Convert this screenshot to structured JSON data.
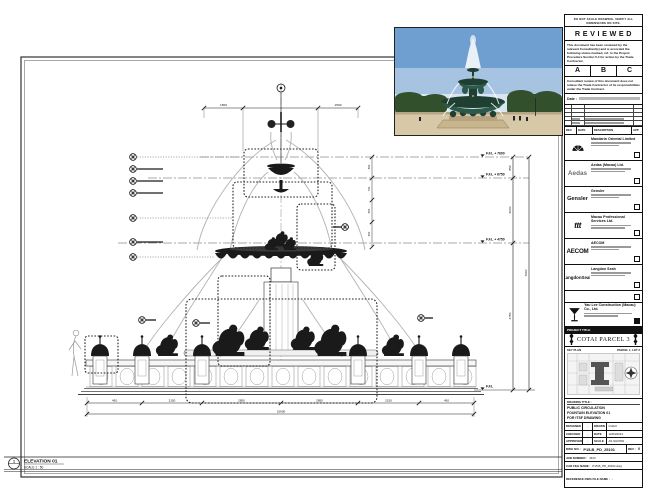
{
  "colors": {
    "ink": "#1a1a1a",
    "sky_top": "#6f9fd0",
    "sky_mid": "#a6c4e2",
    "sky_low": "#d9e6f2",
    "bronze": "#2d5948",
    "bronze_dark": "#1f3f33",
    "stone": "#c8b58e",
    "plaza": "#d7c8a8",
    "tree": "#33502c",
    "spray": "#ffffff"
  },
  "drawing": {
    "view_number": "1",
    "view_title": "ELEVATION 01",
    "view_scale": "SCALE 1 : 50",
    "levels": [
      "F.F.L + 7600",
      "F.F.L + 6750",
      "F.F.L + 4750",
      "F.F.L"
    ],
    "vdims": [
      "850",
      "2000",
      "4750",
      "7600"
    ],
    "top_dims": [
      "1500",
      "1500"
    ],
    "side_dims": [
      "850",
      "700",
      "650",
      "650"
    ],
    "bottom_dims": [
      "450",
      "2150",
      "2850",
      "2850",
      "2150",
      "450"
    ],
    "bottom_overall": "10900"
  },
  "title_block": {
    "disclaimer": "DO NOT SCALE DRAWING. VERIFY ALL DIMENSIONS ON SITE.",
    "stamp": {
      "title": "REVIEWED",
      "para1": "This document has been reviewed by the relevant Consultant(s) and is accorded the following status marked, ref. to the Project Procedure Section 5.4 for action by the Trade Contractor.",
      "statuses": [
        "A",
        "B",
        "C"
      ],
      "para2": "Consultant review of this document does not relieve the Trade Contractor of its responsibilities under the Trade Contract.",
      "date_label": "Date :"
    },
    "rev_header": [
      "REV",
      "DATE",
      "DESCRIPTION",
      "APP"
    ],
    "consultants": [
      {
        "name": "Mandarin Oriental Limited"
      },
      {
        "name": "Aedas (Macau) Ltd.",
        "logo_text": "Aedas"
      },
      {
        "name": "Gensler",
        "logo_text": "Gensler"
      },
      {
        "name": "Macau Professional Services Ltd.",
        "logo_text": "ttt"
      },
      {
        "name": "AECOM",
        "logo_text": "AECOM"
      },
      {
        "name": "Langdon Seah",
        "logo_text": "LangdonSeah"
      }
    ],
    "contractor_name": "Yau Lee Construction (Macau) Co., Ltd.",
    "project_title_label": "PROJECT TITLE",
    "project_title": "COTAI PARCEL 3",
    "key_plan_label": "KEY PLAN",
    "key_plan_sub": "PARCEL 1, LOT 3",
    "drawing_title_label": "DRAWING TITLE :",
    "drawing_title_lines": [
      "PUBLIC CIRCULATION",
      "FOUNTAIN ELEVATION 01",
      "FOR ITSF DRAWING"
    ],
    "sign_rows": [
      {
        "l1": "DESIGNED",
        "v1": "-",
        "l2": "DRAWN",
        "v2": "CHAO"
      },
      {
        "l1": "CHECKED",
        "v1": "-",
        "l2": "DATE",
        "v2": "12/04/2014"
      },
      {
        "l1": "APPROVED",
        "v1": "-",
        "l2": "SCALE",
        "v2": "AS SHOWN"
      }
    ],
    "dwg_no_label": "DWG NO. :",
    "dwg_no": "P15-B_PD_25101",
    "rev_label": "REV :",
    "rev_value": "0",
    "job_label": "JOB NUMBER :",
    "job_value": "3123",
    "cad_label": "CAD FILE NAME :",
    "cad_value": "P15-B_PD_25101.dwg",
    "ref_label": "REFERENCE DWG FILE NAME :",
    "ref_value": "-"
  }
}
